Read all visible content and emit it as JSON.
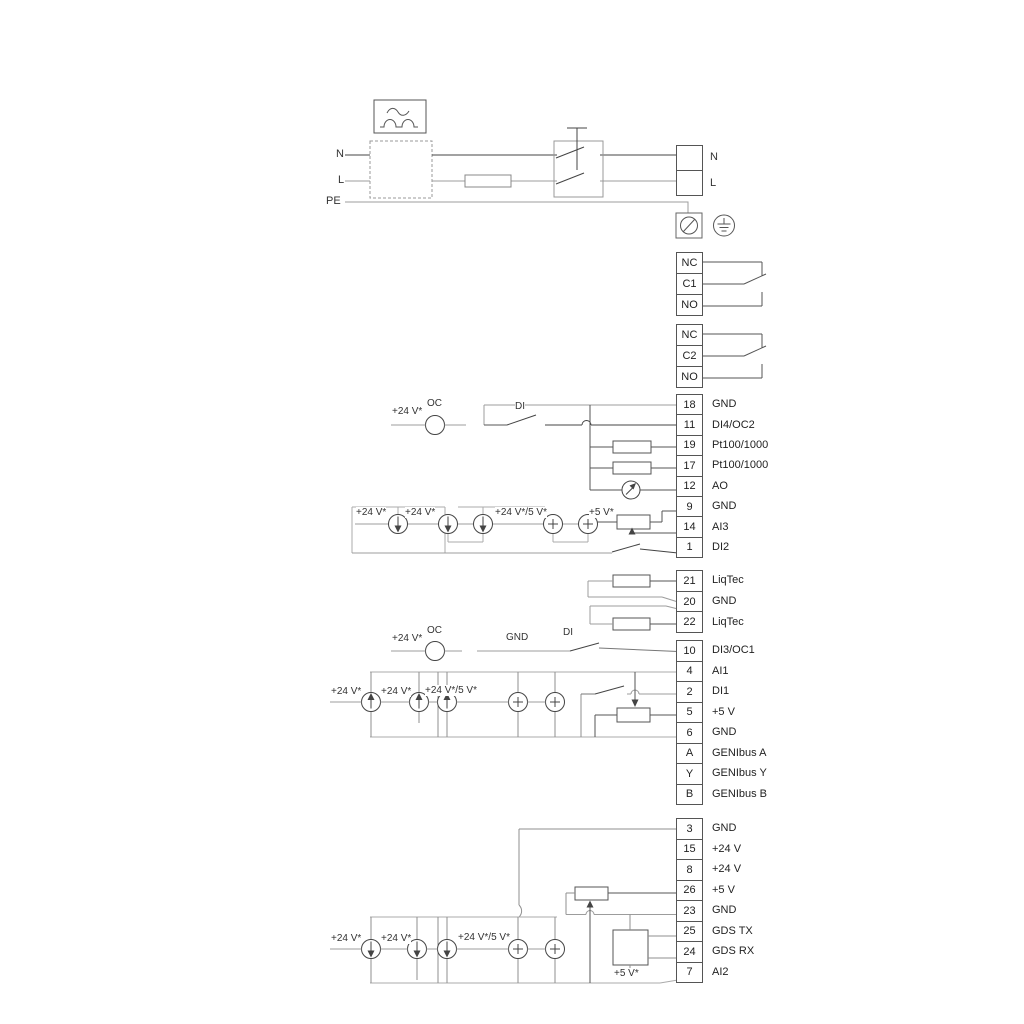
{
  "colors": {
    "background": "#ffffff",
    "wire_dark": "#3f3f3f",
    "wire_gray": "#9c9c9c"
  },
  "power": {
    "left_labels": {
      "n": "N",
      "l": "L",
      "pe": "PE"
    },
    "right_labels": {
      "n": "N",
      "l": "L"
    }
  },
  "relays": {
    "relay1": [
      {
        "num": "NC"
      },
      {
        "num": "C1"
      },
      {
        "num": "NO"
      }
    ],
    "relay2": [
      {
        "num": "NC"
      },
      {
        "num": "C2"
      },
      {
        "num": "NO"
      }
    ]
  },
  "terminals": {
    "groupA": [
      {
        "num": "18",
        "label": "GND"
      },
      {
        "num": "11",
        "label": "DI4/OC2"
      },
      {
        "num": "19",
        "label": "Pt100/1000"
      },
      {
        "num": "17",
        "label": "Pt100/1000"
      },
      {
        "num": "12",
        "label": "AO"
      },
      {
        "num": "9",
        "label": "GND"
      },
      {
        "num": "14",
        "label": "AI3"
      },
      {
        "num": "1",
        "label": "DI2"
      }
    ],
    "groupB": [
      {
        "num": "21",
        "label": "LiqTec"
      },
      {
        "num": "20",
        "label": "GND"
      },
      {
        "num": "22",
        "label": "LiqTec"
      }
    ],
    "groupC": [
      {
        "num": "10",
        "label": "DI3/OC1"
      },
      {
        "num": "4",
        "label": "AI1"
      },
      {
        "num": "2",
        "label": "DI1"
      },
      {
        "num": "5",
        "label": "+5 V"
      },
      {
        "num": "6",
        "label": "GND"
      },
      {
        "num": "A",
        "label": "GENIbus A"
      },
      {
        "num": "Y",
        "label": "GENIbus Y"
      },
      {
        "num": "B",
        "label": "GENIbus B"
      }
    ],
    "groupD": [
      {
        "num": "3",
        "label": "GND"
      },
      {
        "num": "15",
        "label": "+24 V"
      },
      {
        "num": "8",
        "label": "+24 V"
      },
      {
        "num": "26",
        "label": "+5 V"
      },
      {
        "num": "23",
        "label": "GND"
      },
      {
        "num": "25",
        "label": "GDS TX"
      },
      {
        "num": "24",
        "label": "GDS RX"
      },
      {
        "num": "7",
        "label": "AI2"
      }
    ]
  },
  "annotations": {
    "a1": "+24 V*",
    "a2": "OC",
    "a3": "DI",
    "a4": "+24 V*",
    "a5": "+24 V*",
    "a6": "+24 V*/5 V*",
    "a7": "+5 V*",
    "a8": "+24 V*",
    "a9": "OC",
    "a10": "GND",
    "a11": "DI",
    "a12": "+24 V*",
    "a13": "+24 V*",
    "a14": "+24 V*/5 V*",
    "a15": "+24 V*",
    "a16": "+24 V*",
    "a17": "+24 V*/5 V*",
    "a18": "+5 V*"
  }
}
